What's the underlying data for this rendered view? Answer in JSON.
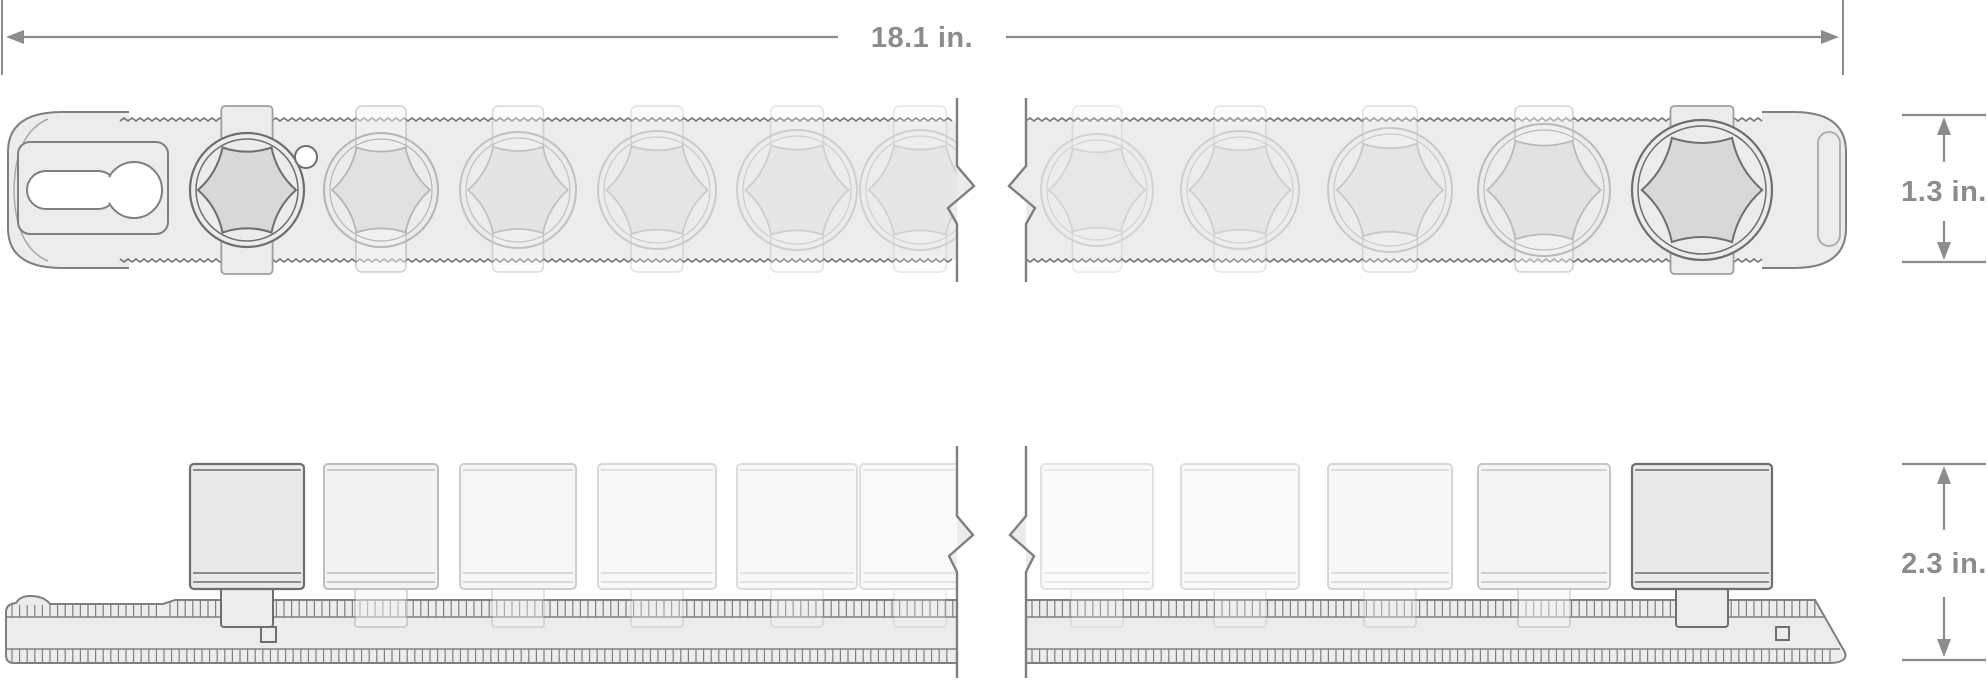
{
  "diagram": {
    "name": "socket-rail-dimension-diagram",
    "dimensions": {
      "overall_width": {
        "label": "18.1 in."
      },
      "rail_height": {
        "label": "1.3 in."
      },
      "side_height": {
        "label": "2.3 in."
      }
    },
    "colors": {
      "background": "#ffffff",
      "outline": "#7f7f7f",
      "outline_dark": "#6e6e6e",
      "outline_light": "#a9a9a9",
      "clip_stroke": "#9e9e9e",
      "fill_light": "#ececec",
      "socket_fill": "#e9e9e9",
      "hex_fill": "#d8d8d8",
      "ghost_fill": "#f5f5f5",
      "white": "#ffffff",
      "dimension": "#8c8c8c"
    },
    "rail": {
      "break_left_x": 957,
      "break_right_x": 1026,
      "top_view_y": {
        "top": 121,
        "bottom": 259
      },
      "side_view_y": {
        "top": 600,
        "bottom": 663
      }
    },
    "sockets": [
      {
        "cx": 247,
        "r": 57,
        "style": "highlighted",
        "opacity": 1,
        "detent": true
      },
      {
        "cx": 381,
        "r": 57,
        "style": "ghost",
        "opacity": 0.5,
        "detent": false
      },
      {
        "cx": 518,
        "r": 58,
        "style": "ghost",
        "opacity": 0.38,
        "detent": false
      },
      {
        "cx": 657,
        "r": 59,
        "style": "ghost",
        "opacity": 0.3,
        "detent": false
      },
      {
        "cx": 797,
        "r": 60,
        "style": "ghost",
        "opacity": 0.27,
        "detent": false
      },
      {
        "cx": 920,
        "r": 60,
        "style": "ghost",
        "opacity": 0.25,
        "detent": false
      },
      {
        "cx": 1097,
        "r": 56,
        "style": "ghost",
        "opacity": 0.22,
        "detent": false
      },
      {
        "cx": 1240,
        "r": 59,
        "style": "ghost",
        "opacity": 0.26,
        "detent": false
      },
      {
        "cx": 1390,
        "r": 62,
        "style": "ghost",
        "opacity": 0.32,
        "detent": false
      },
      {
        "cx": 1544,
        "r": 66,
        "style": "ghost",
        "opacity": 0.45,
        "detent": false
      },
      {
        "cx": 1702,
        "r": 70,
        "style": "highlighted",
        "opacity": 1,
        "detent": false
      }
    ]
  }
}
